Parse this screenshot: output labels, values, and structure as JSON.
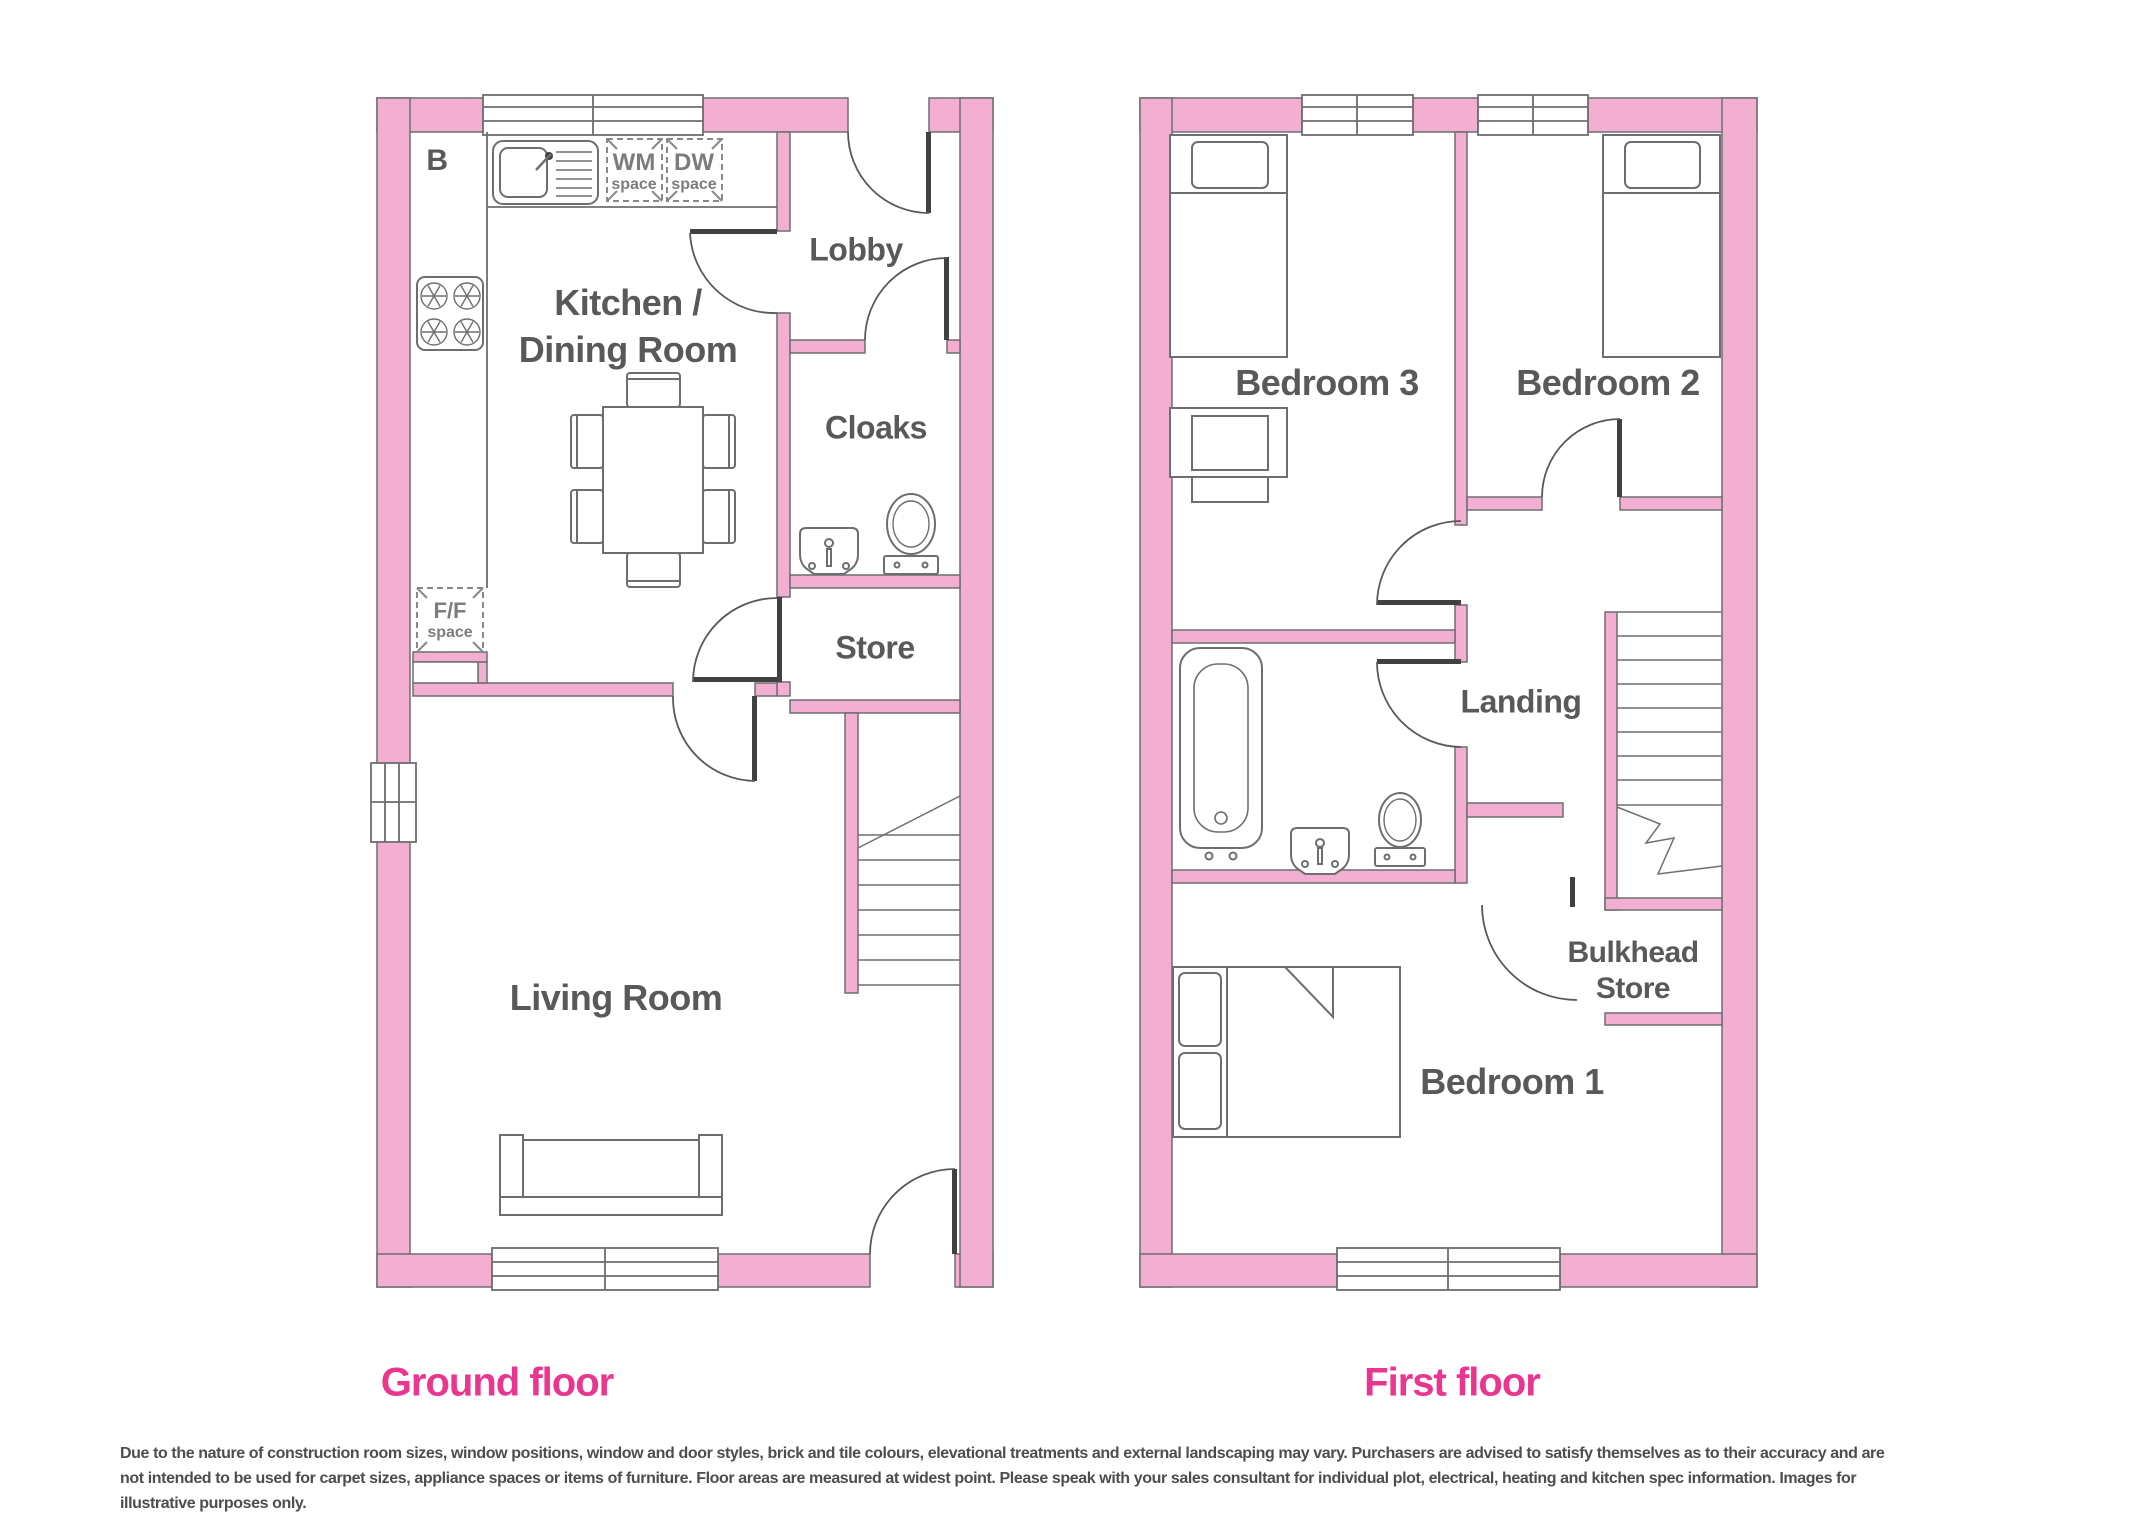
{
  "document": {
    "type": "house-floor-plan",
    "background": "#ffffff"
  },
  "colors": {
    "wall_fill": "#f2afd2",
    "wall_stroke": "#6d6e71",
    "furniture_stroke": "#6d6e71",
    "door_leaf": "#414042",
    "room_label": "#58595b",
    "appliance_label": "#7b7c7f",
    "heading_pink": "#e9368f",
    "footer_text": "#4d4d4f"
  },
  "ground_floor": {
    "heading": "Ground floor",
    "labels": {
      "boiler": "B",
      "kitchen_line1": "Kitchen /",
      "kitchen_line2": "Dining Room",
      "lobby": "Lobby",
      "cloaks": "Cloaks",
      "store": "Store",
      "living_room": "Living Room",
      "wm_line1": "WM",
      "wm_line2": "space",
      "dw_line1": "DW",
      "dw_line2": "space",
      "ff_line1": "F/F",
      "ff_line2": "space"
    }
  },
  "first_floor": {
    "heading": "First floor",
    "labels": {
      "bedroom3": "Bedroom 3",
      "bedroom2": "Bedroom 2",
      "landing": "Landing",
      "bulkhead_line1": "Bulkhead",
      "bulkhead_line2": "Store",
      "bedroom1": "Bedroom 1"
    }
  },
  "footer": {
    "lines": [
      "Due to the nature of construction room sizes, window positions, window and door styles, brick and tile colours, elevational treatments and external landscaping may vary. Purchasers are advised to satisfy themselves as to their accuracy and are",
      "not intended to be used for carpet sizes, appliance spaces or items of furniture. Floor areas are measured at widest point. Please speak with your sales consultant for individual plot, electrical, heating and kitchen spec information. Images for",
      "illustrative purposes only."
    ]
  }
}
